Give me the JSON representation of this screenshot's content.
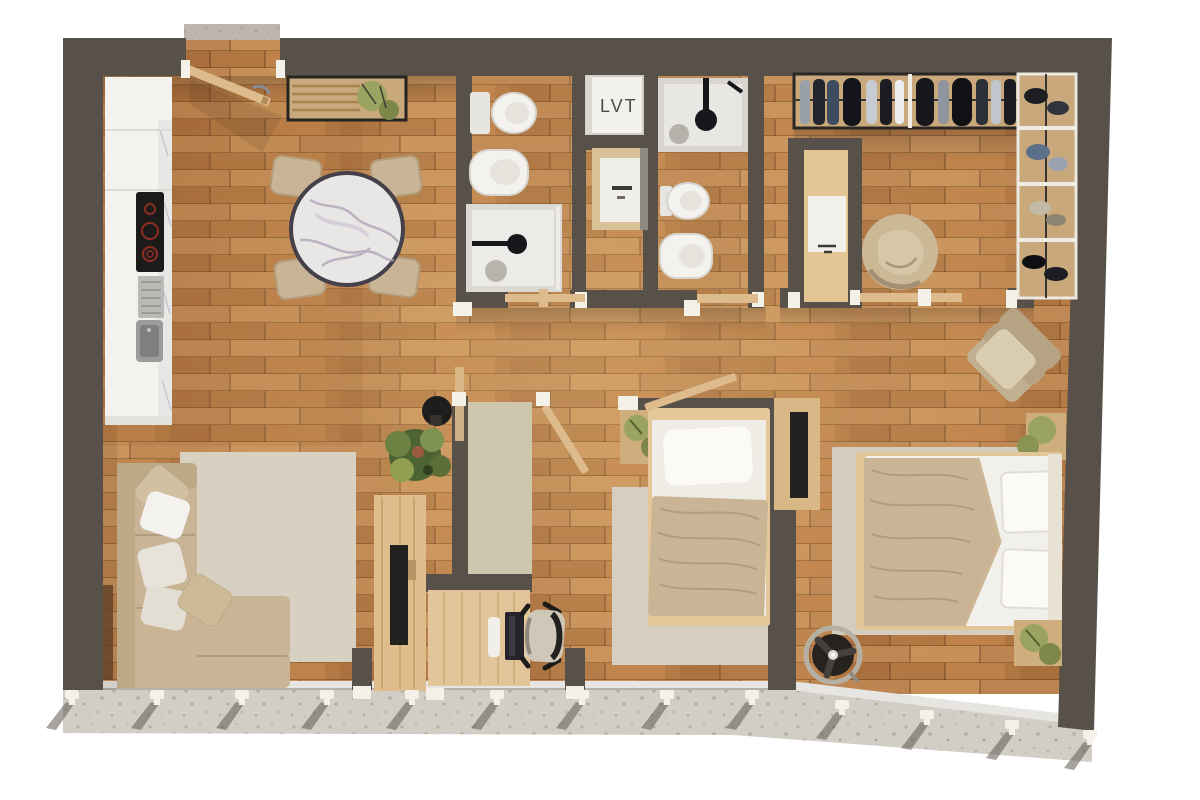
{
  "canvas": {
    "width": 1200,
    "height": 800
  },
  "labels": {
    "utility_closet": "LVT"
  },
  "colors": {
    "background": "#ffffff",
    "wall": "#585149",
    "wall_dark": "#4c4640",
    "floor_wood": "#bc8450",
    "terrazzo": "#d2cec5",
    "terrazzo_dot": "#b3aea3",
    "white_fixture": "#f3f2ee",
    "marble": "#e9e7e6",
    "marble_vein": "#aaa2b4",
    "cooktop": "#1d1b1a",
    "burner_red": "#8d2c23",
    "steel": "#95979a",
    "light_wood": "#ddbb8c",
    "mid_wood": "#cfae7d",
    "beige_fabric": "#c9b596",
    "beige_light": "#d9cdb4",
    "pillow_white": "#eceae2",
    "rug": "#d8d1c2",
    "carpet_nook": "#cfc6ae",
    "tv_black": "#23211f",
    "plant_green": "#5e6f3d",
    "plant_olive": "#9aa35f",
    "jamb_white": "#f4f1e9",
    "dark_item": "#26231f"
  },
  "items": [
    "entry-door",
    "entry-console",
    "kitchen-counter",
    "cooktop",
    "kitchen-sink",
    "dining-table",
    "dining-chairs",
    "bathroom-1-toilet",
    "bathroom-1-basin",
    "bathroom-1-shower",
    "utility-closet-lvt",
    "laundry-cabinet",
    "bathroom-2-shower",
    "bathroom-2-toilet",
    "bathroom-2-basin",
    "dressing-wardrobe-top",
    "dressing-wardrobe-right",
    "dressing-desk",
    "bean-bag",
    "storage-closet",
    "study-desk",
    "office-chair",
    "monitor",
    "tv-console",
    "tv",
    "monstera-plant",
    "speaker",
    "sofa",
    "living-rug",
    "single-bed",
    "single-bed-side-table",
    "wall-tv",
    "double-bed",
    "double-bed-side-tables",
    "armchair",
    "floor-fan",
    "balcony",
    "railing-posts"
  ]
}
